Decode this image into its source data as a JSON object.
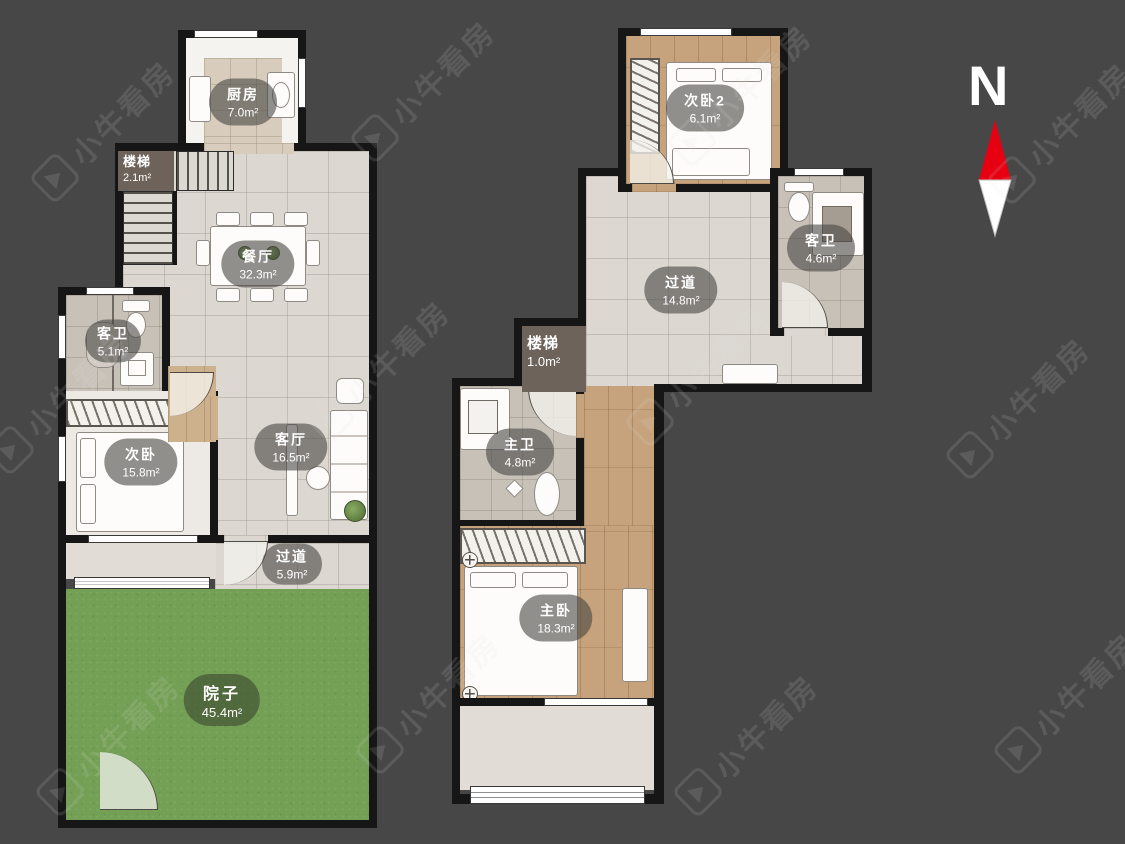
{
  "watermark": {
    "text": "小牛看房"
  },
  "compass": {
    "label": "N"
  },
  "palette": {
    "background": "#474747",
    "wall": "#161616",
    "tile_floor": "#dcd7d1",
    "wood_floor": "#c6a37c",
    "grass": "#74a055",
    "compass_red": "#e60012",
    "label_bubble": "rgba(72,70,66,0.6)",
    "stair_label_block": "#6e635a"
  },
  "floor1": {
    "rooms": [
      {
        "name": "厨房",
        "area": "7.0m²"
      },
      {
        "name": "楼梯",
        "area": "2.1m²"
      },
      {
        "name": "餐厅",
        "area": "32.3m²"
      },
      {
        "name": "客卫",
        "area": "5.1m²"
      },
      {
        "name": "次卧",
        "area": "15.8m²"
      },
      {
        "name": "客厅",
        "area": "16.5m²"
      },
      {
        "name": "过道",
        "area": "5.9m²"
      },
      {
        "name": "院子",
        "area": "45.4m²"
      }
    ]
  },
  "floor2": {
    "rooms": [
      {
        "name": "次卧2",
        "area": "6.1m²"
      },
      {
        "name": "客卫",
        "area": "4.6m²"
      },
      {
        "name": "过道",
        "area": "14.8m²"
      },
      {
        "name": "楼梯",
        "area": "1.0m²"
      },
      {
        "name": "主卫",
        "area": "4.8m²"
      },
      {
        "name": "主卧",
        "area": "18.3m²"
      }
    ]
  }
}
